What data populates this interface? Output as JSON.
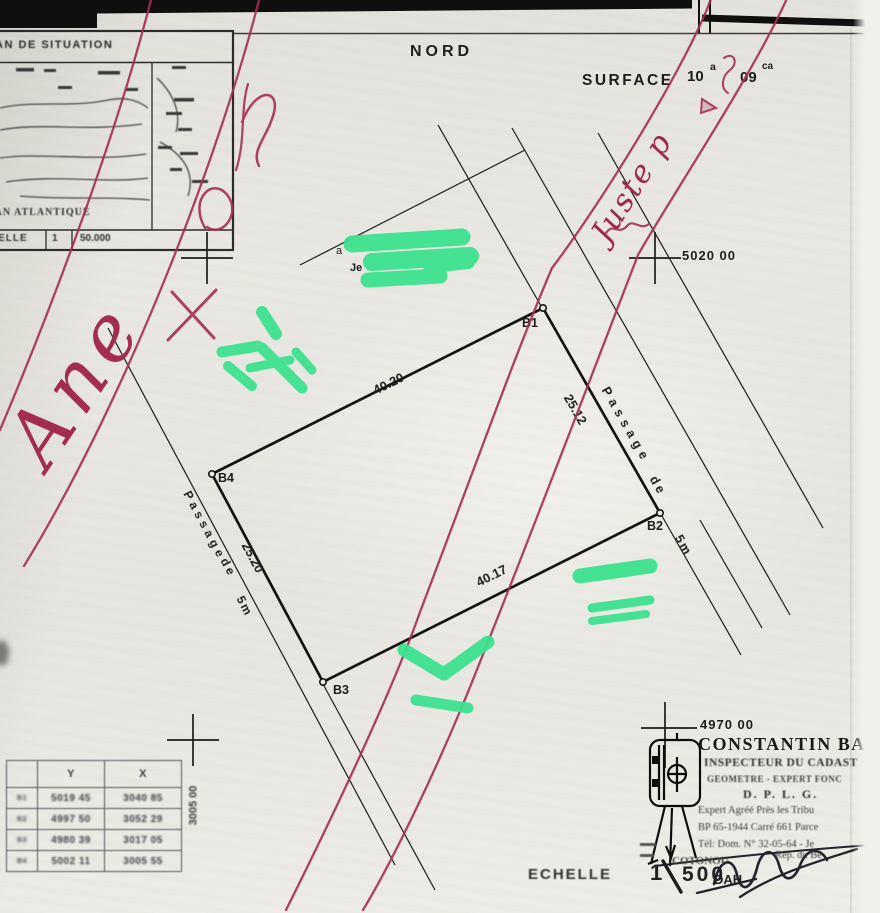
{
  "colors": {
    "paper": "#e9e8e3",
    "ink": "#1d1d1d",
    "red_ink": "#a52e52",
    "green_marker": "#3ce28e"
  },
  "header": {
    "north_label": "NORD",
    "surface_label": "SURFACE",
    "are_value": "10",
    "are_unit": "a",
    "centiare_value": "09",
    "centiare_unit": "ca"
  },
  "inset_map": {
    "title": "PLAN DE SITUATION",
    "ocean_label": "OCEAN ATLANTIQUE",
    "scale_label": "ECHELLE",
    "scale_num": "1",
    "scale_den": "50.000"
  },
  "grid_marks": {
    "northeast": "5020 00",
    "southeast": "4970 00",
    "south_vertical": "3005 00"
  },
  "parcel": {
    "corner_b1": "B1",
    "corner_b2": "B2",
    "corner_b3": "B3",
    "corner_b4": "B4",
    "dim_top": "40.20",
    "dim_right": "25.12",
    "dim_bottom": "40.17",
    "dim_left": "25.20"
  },
  "passage_right": {
    "word1": "Passage",
    "word2": "de",
    "word3": "5m"
  },
  "passage_left": {
    "word1": "Passage",
    "word2": "de",
    "word3": "5m"
  },
  "handwriting": {
    "right_note": "Juste p",
    "left_note": "Ane"
  },
  "marker_fragments": {
    "f1": "a",
    "f2": "Je"
  },
  "coord_table": {
    "col_point": "",
    "col_y": "Y",
    "col_x": "X",
    "rows": [
      {
        "pt": "B1",
        "y": "5019 45",
        "x": "3040 85"
      },
      {
        "pt": "B2",
        "y": "4997 50",
        "x": "3052 29"
      },
      {
        "pt": "B3",
        "y": "4980 39",
        "x": "3017 05"
      },
      {
        "pt": "B4",
        "y": "5002 11",
        "x": "3005 55"
      }
    ]
  },
  "surveyor_block": {
    "name": "CONSTANTIN BA",
    "title1": "INSPECTEUR DU CADAST",
    "title2": "GEOMETRE  -  EXPERT FONC",
    "title3": "D. P. L. G.",
    "line4": "Expert Agréé Près les Tribu",
    "line5": "BP 65-1944 Carré 661 Parce",
    "line6": "Tél: Dom. N° 32-05-64 - Je",
    "city": "COTONOU",
    "country_line": "Rép. du Bé",
    "country_abbr": "DAH"
  },
  "scale_block": {
    "label": "ECHELLE",
    "num": "1",
    "den": "500"
  }
}
